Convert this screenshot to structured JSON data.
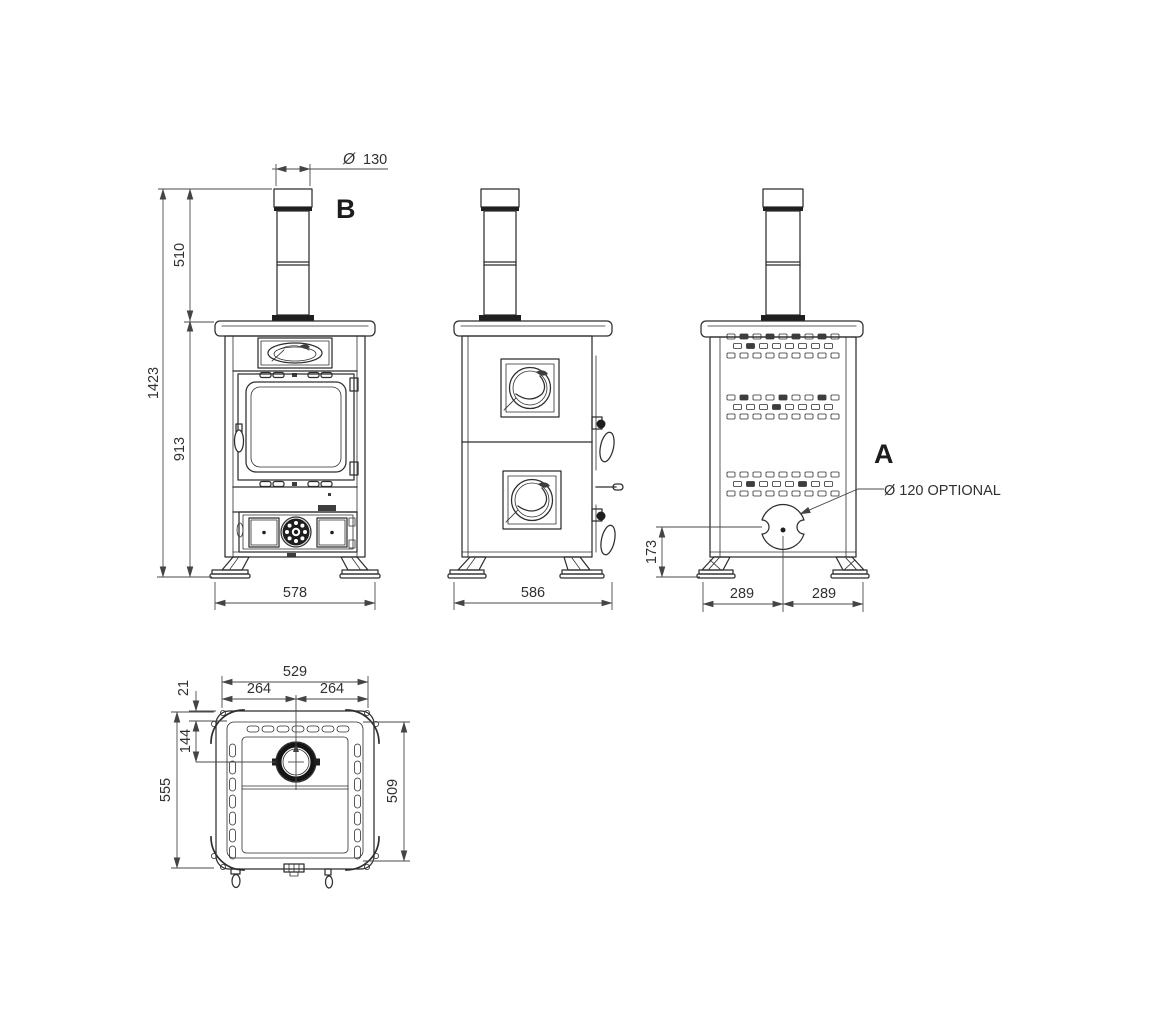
{
  "drawing": {
    "type": "technical-drawing",
    "subject": "wood stove dimensional views",
    "colors": {
      "background": "#ffffff",
      "line": "#2e2e2e",
      "dimension_line": "#4a4a4a",
      "text": "#303030",
      "dark_fill": "#1f1f1f"
    },
    "views": {
      "front": {
        "name": "front elevation",
        "section_label": "B",
        "dims": {
          "flue_diameter_symbol": "Ø",
          "flue_diameter": "130",
          "total_height": "1423",
          "flue_height": "510",
          "body_height": "913",
          "width": "578"
        }
      },
      "side": {
        "name": "side elevation",
        "dims": {
          "depth": "586"
        }
      },
      "back": {
        "name": "rear elevation",
        "section_label": "A",
        "outlet_note": "Ø 120 OPTIONAL",
        "dims": {
          "outlet_center_height": "173",
          "outlet_center_from_left": "289",
          "outlet_center_from_right": "289"
        }
      },
      "top": {
        "name": "top plan",
        "dims": {
          "body_width": "529",
          "flue_center_from_left": "264",
          "flue_center_from_right": "264",
          "rim_depth": "21",
          "flue_center_from_back": "144",
          "total_depth": "555",
          "body_depth": "509"
        }
      }
    }
  }
}
